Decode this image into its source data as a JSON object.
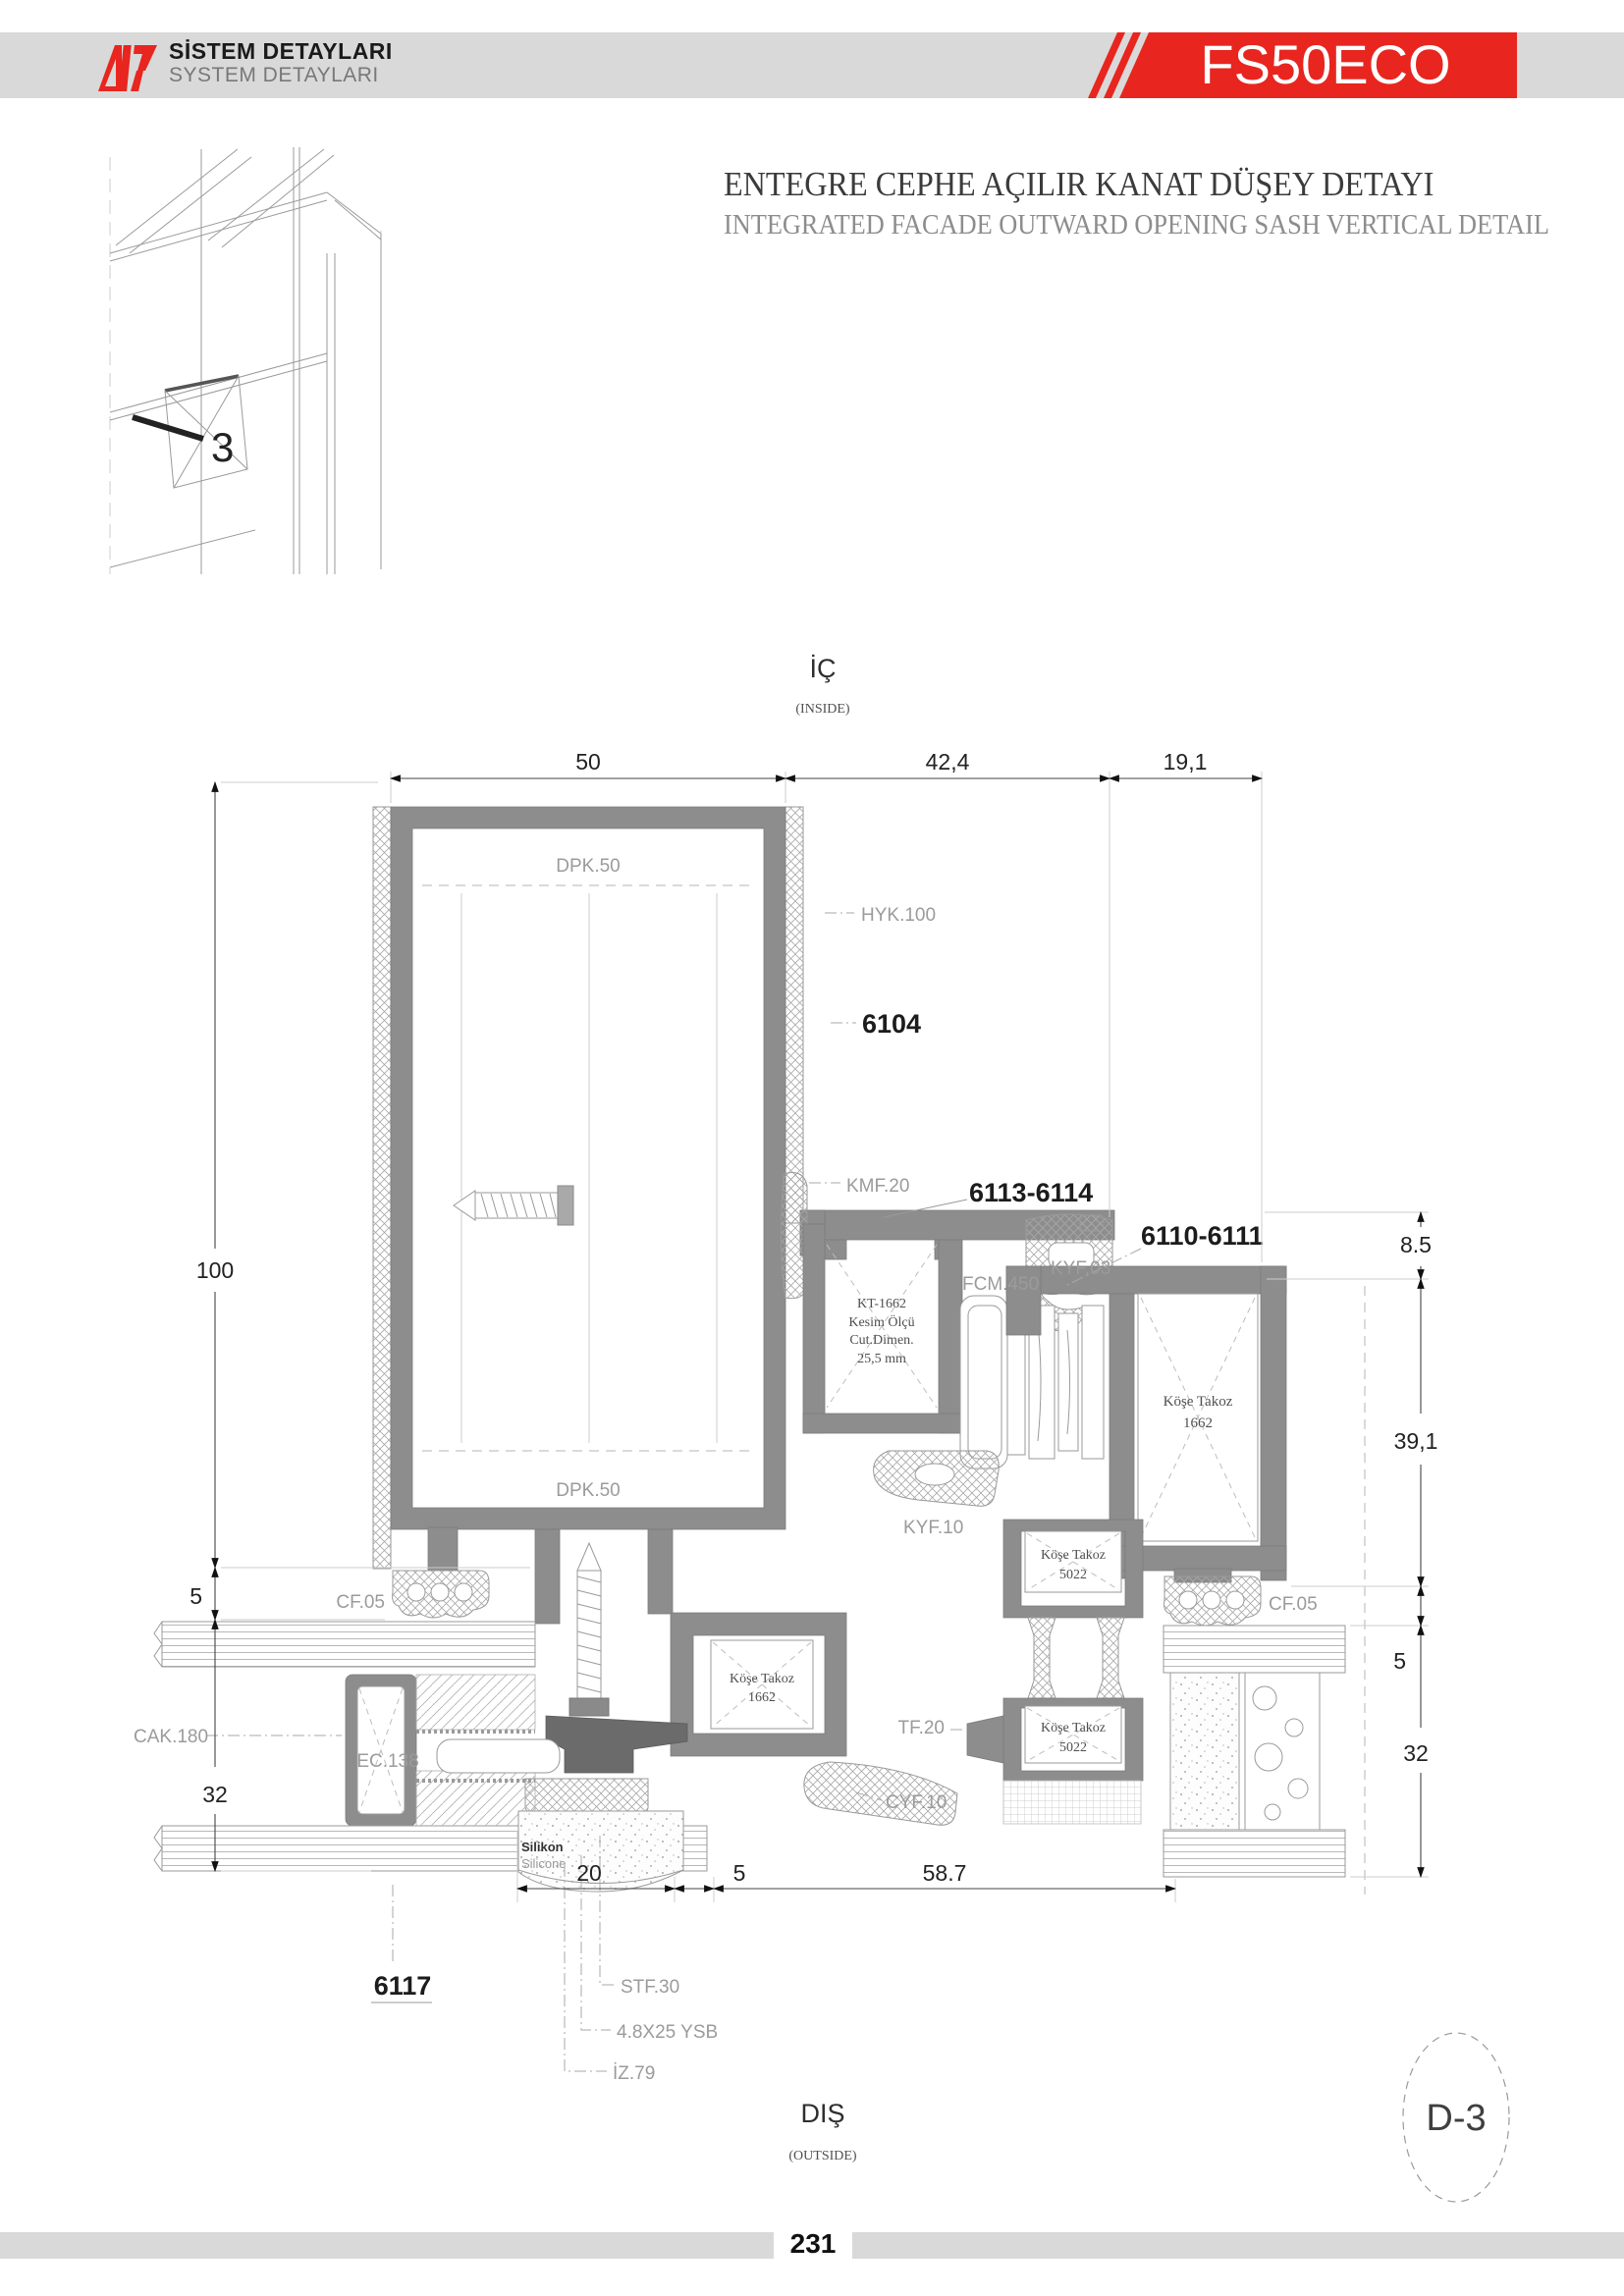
{
  "header": {
    "logo_title": "SİSTEM DETAYLARI",
    "logo_subtitle": "SYSTEM DETAYLARI",
    "product": "FS50ECO"
  },
  "title": {
    "tr": "ENTEGRE CEPHE AÇILIR KANAT DÜŞEY DETAYI",
    "en": "INTEGRATED FACADE OUTWARD OPENING SASH VERTICAL DETAIL"
  },
  "thumb": {
    "marker": "3"
  },
  "inside": {
    "tr": "İÇ",
    "en": "(INSIDE)"
  },
  "outside": {
    "tr": "DIŞ",
    "en": "(OUTSIDE)"
  },
  "dims": {
    "w_mullion": "50",
    "w_sash": "42,4",
    "w_frame": "19,1",
    "h_mullion": "100",
    "gap_left": "5",
    "glass_left": "32",
    "h_top_right": "8.5",
    "h_sash_right": "39,1",
    "gap_right": "5",
    "glass_right": "32",
    "b_anchor": "20",
    "b_gap": "5",
    "b_glass": "58.7"
  },
  "labels": {
    "dpk": "DPK.50",
    "hyk": "HYK.100",
    "n6104": "6104",
    "kmf": "KMF.20",
    "n6113": "6113-6114",
    "n6110": "6110-6111",
    "kyf03": "KYF.03",
    "fcm": "FCM.450",
    "kt1": "KT-1662",
    "kt2": "Kesim Ölçü",
    "kt3": "Cut.Dimen.",
    "kt4": "25,5 mm",
    "kose": "Köşe Takoz",
    "kose1662": "1662",
    "kose5022": "5022",
    "kyf10": "KYF.10",
    "cf05": "CF.05",
    "cak": "CAK.180",
    "ec": "EC.138",
    "tf": "TF.20",
    "cyf": "CYF.10",
    "sil_tr": "Silikon",
    "sil_en": "Silicone",
    "n6117": "6117",
    "stf": "STF.30",
    "ysb": "4.8X25 YSB",
    "iz": "İZ.79"
  },
  "ref": {
    "detail": "D-3"
  },
  "footer": {
    "page": "231"
  },
  "colors": {
    "accent_red": "#e8251f",
    "profile_gray": "#8d8d8d",
    "dark_gray": "#6b6b6b",
    "bar_gray": "#d9d9d9",
    "label_gray": "#9b9b9b"
  }
}
